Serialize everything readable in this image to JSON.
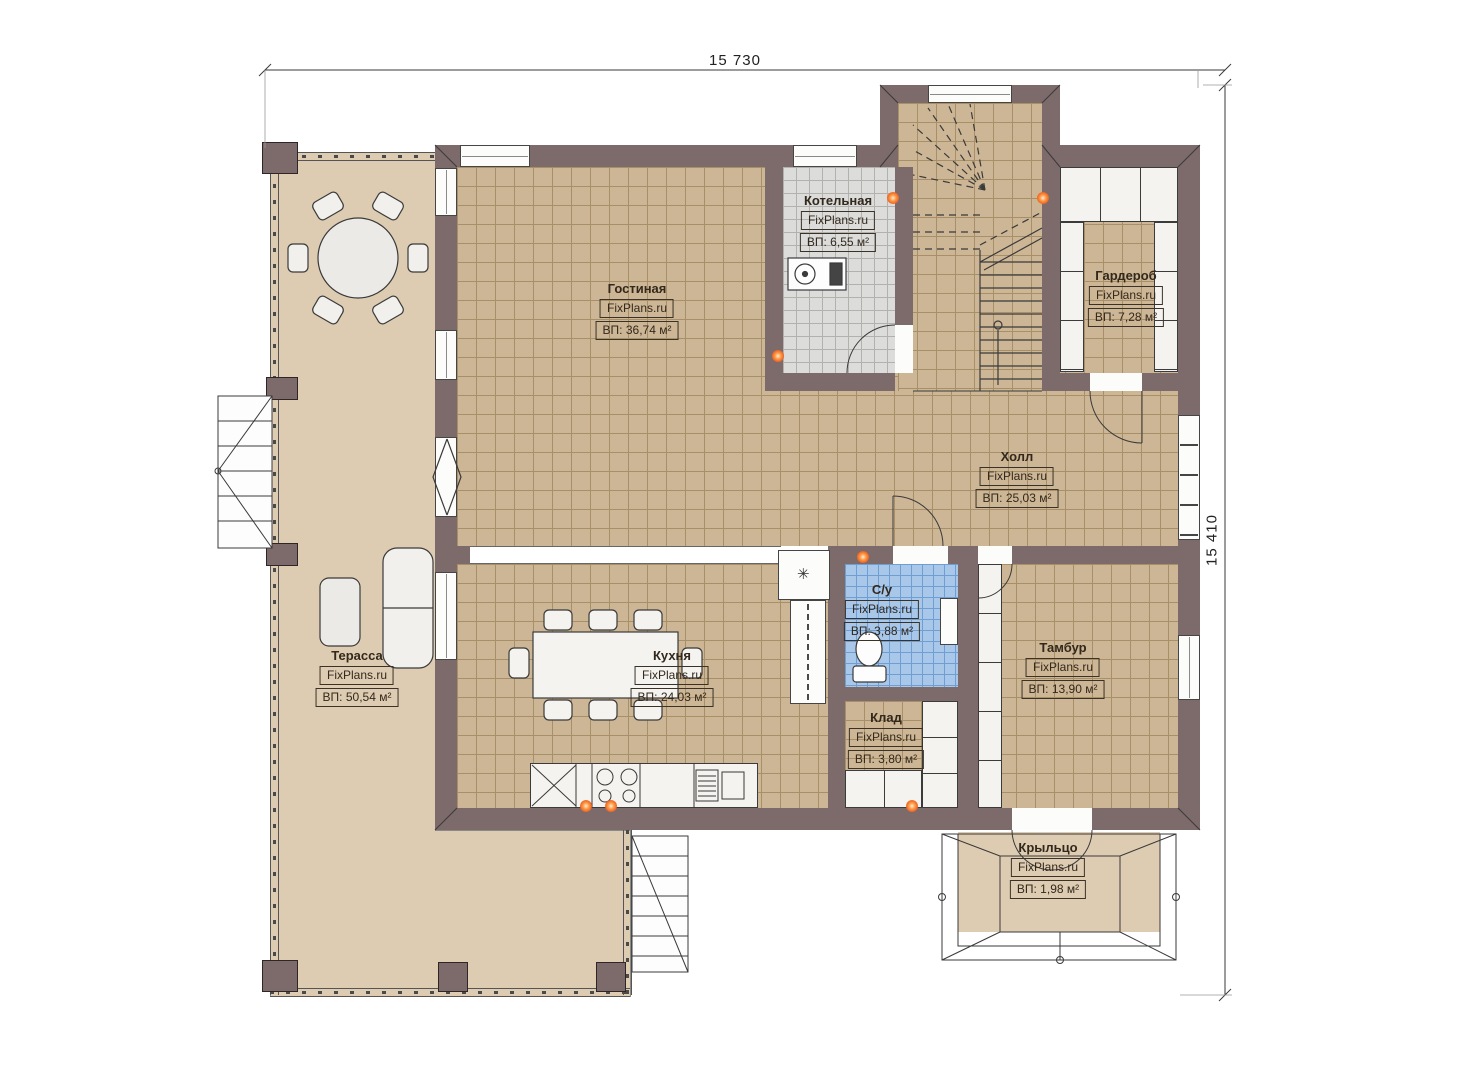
{
  "branding": {
    "site": "FixPlans.ru"
  },
  "dimensions": {
    "width_label": "15 730",
    "height_label": "15 410"
  },
  "symbols": {
    "vent": "✳"
  },
  "colors": {
    "wall": "#7d6a6b",
    "floor_tile": "#cdb695",
    "terrace": "#ddccb2",
    "boiler_tile": "#dcdcda",
    "bathroom_tile": "#a9c7e9",
    "accent_orange": "#ef6a25"
  },
  "rooms": [
    {
      "id": "kotelnaya",
      "name": "Котельная",
      "area": "ВП: 6,55 м²"
    },
    {
      "id": "gostinaya",
      "name": "Гостиная",
      "area": "ВП: 36,74 м²"
    },
    {
      "id": "garderob",
      "name": "Гардероб",
      "area": "ВП: 7,28 м²"
    },
    {
      "id": "holl",
      "name": "Холл",
      "area": "ВП: 25,03 м²"
    },
    {
      "id": "terassa",
      "name": "Терасса",
      "area": "ВП: 50,54 м²"
    },
    {
      "id": "kuhnya",
      "name": "Кухня",
      "area": "ВП: 24,03 м²"
    },
    {
      "id": "su",
      "name": "С/у",
      "area": "ВП: 3,88 м²"
    },
    {
      "id": "klad",
      "name": "Клад",
      "area": "ВП: 3,80 м²"
    },
    {
      "id": "tambur",
      "name": "Тамбур",
      "area": "ВП: 13,90 м²"
    },
    {
      "id": "krylco",
      "name": "Крыльцо",
      "area": "ВП: 1,98 м²"
    }
  ]
}
